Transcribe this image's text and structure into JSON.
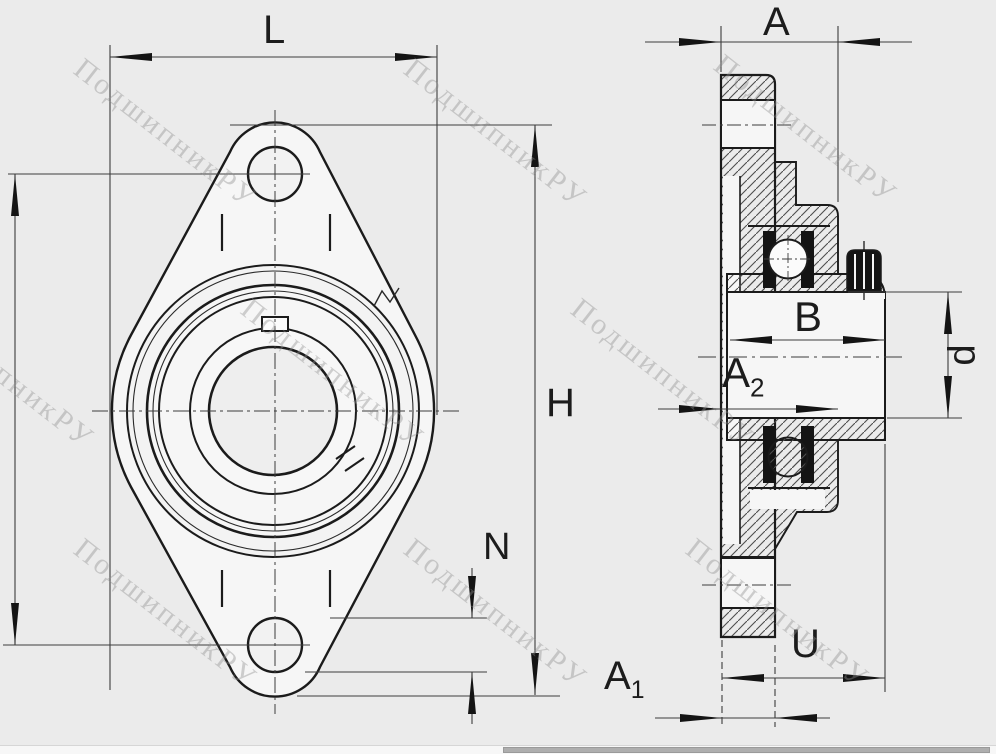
{
  "page": {
    "background": "#ebebeb"
  },
  "watermark": {
    "text": "ПодшипникРУ",
    "color": "#8f8f8f"
  },
  "drawing": {
    "description": "Two-view technical drawing of a 2-bolt oval flange bearing unit: front view (left) and full-section side view (right)"
  },
  "dims": {
    "L": "L",
    "A": "A",
    "H": "H",
    "N": "N",
    "B": "B",
    "U": "U",
    "d": "d",
    "A1": {
      "base": "A",
      "sub": "1"
    },
    "A2": {
      "base": "A",
      "sub": "2"
    }
  },
  "colors": {
    "line_main": "#1b1b1b",
    "line_thin": "#3c3c3c",
    "fill_body": "#f6f6f6",
    "seal_black": "#141414"
  }
}
